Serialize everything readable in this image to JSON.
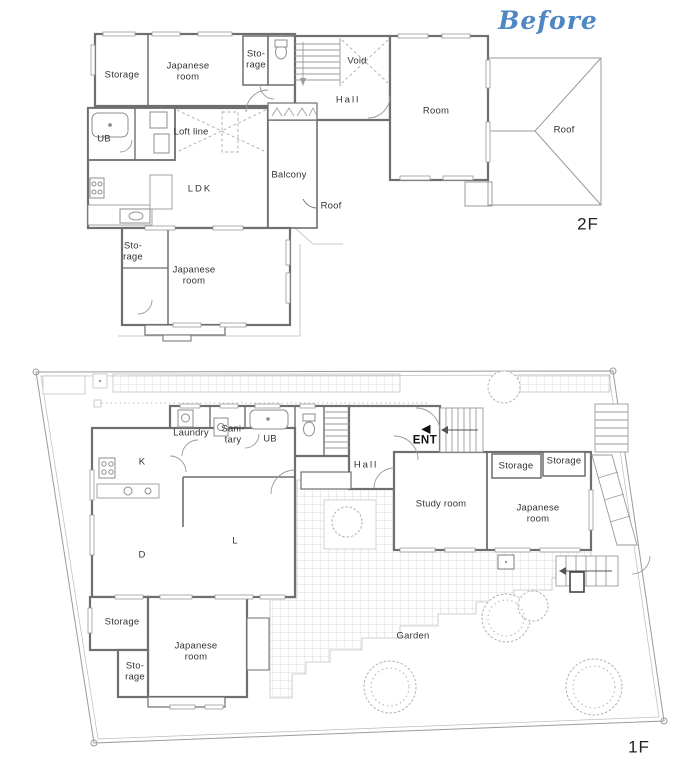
{
  "annotation": {
    "text": "Before"
  },
  "palette": {
    "accent": "#4e87c2",
    "wall": "#6f6f6f",
    "thin_line": "#999999",
    "grid_line": "#d2d2d2",
    "text": "#333333"
  },
  "floor_2f": {
    "floor_label": "2F",
    "labels": {
      "storage_top": "Storage",
      "japanese_room_top": "Japanese\nroom",
      "storage_small": "Sto-\nrage",
      "void": "Void",
      "hall": "Hall",
      "room": "Room",
      "roof_right": "Roof",
      "ub": "UB",
      "loft_line": "Loft line",
      "ldk": "LDK",
      "balcony": "Balcony",
      "roof_note": "Roof",
      "storage_lower": "Sto-\nrage",
      "japanese_room_lower": "Japanese\nroom"
    }
  },
  "floor_1f": {
    "floor_label": "1F",
    "labels": {
      "laundry": "Laundry",
      "sanitary": "Sani-\ntary",
      "ub": "UB",
      "hall": "Hall",
      "ent": "ENT",
      "ent_arrow": "◀",
      "kitchen": "K",
      "dining": "D",
      "living": "L",
      "study_room": "Study room",
      "storage_mid": "Storage",
      "storage_right": "Storage",
      "japanese_room_right": "Japanese\nroom",
      "storage_bottom": "Storage",
      "japanese_room_bottom": "Japanese\nroom",
      "storage_small": "Sto-\nrage",
      "garden": "Garden",
      "edge_partial": "F"
    }
  }
}
